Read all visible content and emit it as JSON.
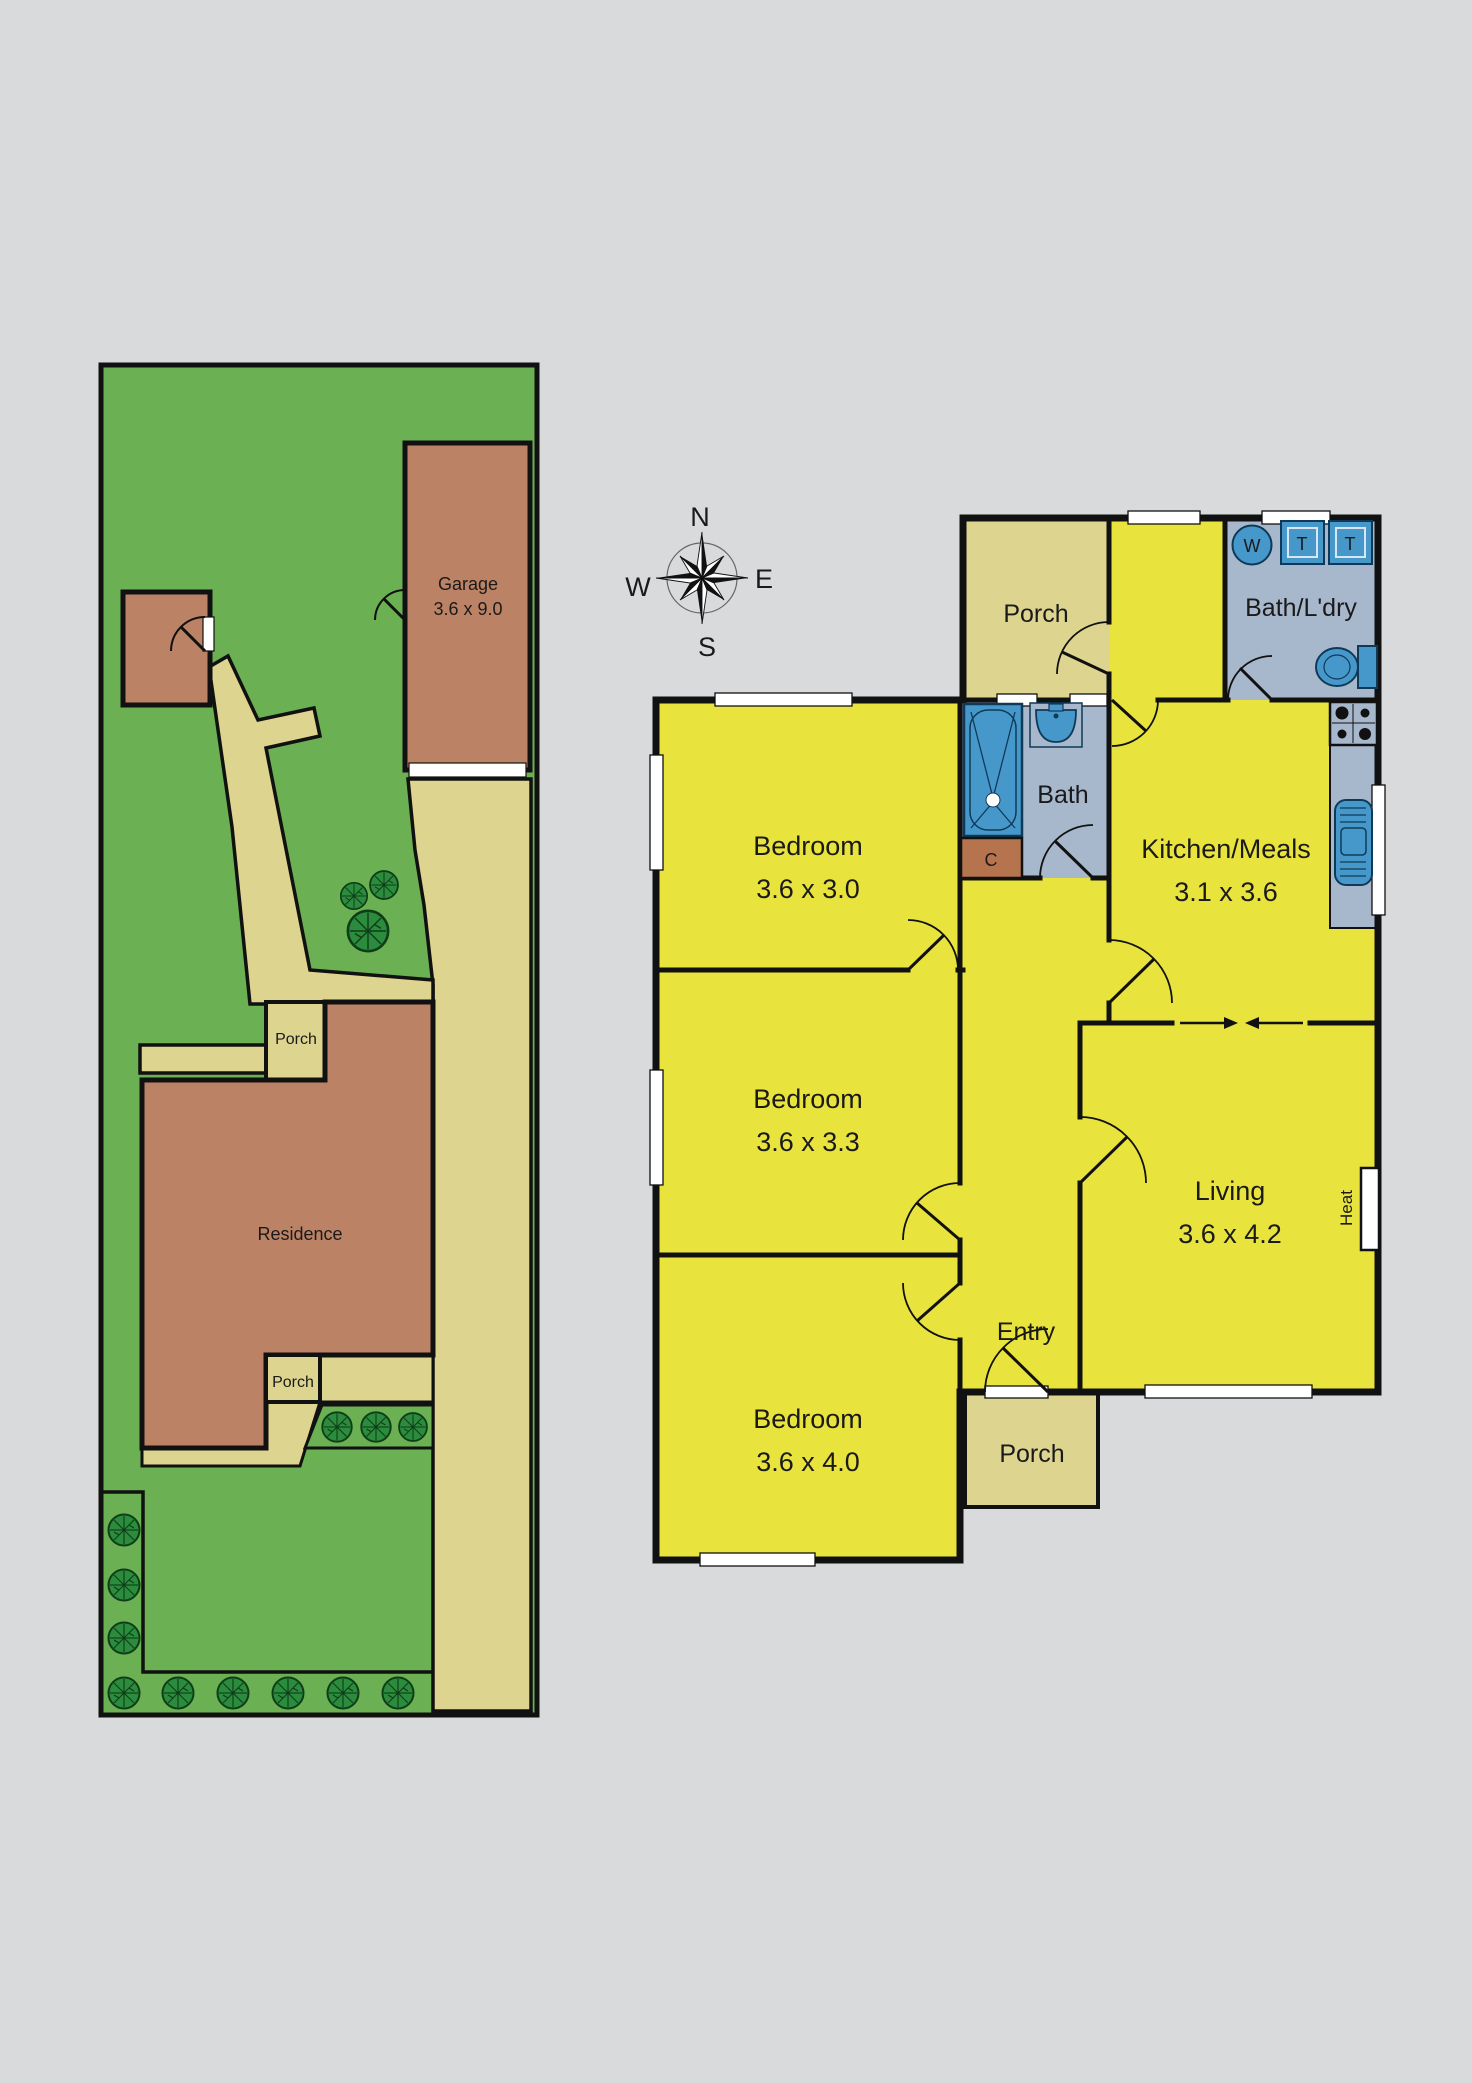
{
  "compass": {
    "north": "N",
    "east": "E",
    "south": "S",
    "west": "W"
  },
  "site_plan": {
    "garage_label": "Garage",
    "garage_dims": "3.6 x 9.0",
    "residence_label": "Residence",
    "porch_upper_label": "Porch",
    "porch_lower_label": "Porch"
  },
  "floor_plan": {
    "bedroom1_label": "Bedroom",
    "bedroom1_dims": "3.6 x 3.0",
    "bedroom2_label": "Bedroom",
    "bedroom2_dims": "3.6 x 3.3",
    "bedroom3_label": "Bedroom",
    "bedroom3_dims": "3.6 x 4.0",
    "kitchen_label": "Kitchen/Meals",
    "kitchen_dims": "3.1 x 3.6",
    "living_label": "Living",
    "living_dims": "3.6 x 4.2",
    "bath_label": "Bath",
    "bath_laundry_label": "Bath/L'dry",
    "porch_top_label": "Porch",
    "porch_bottom_label": "Porch",
    "entry_label": "Entry",
    "heater_label": "Heat",
    "cupboard_label": "C",
    "washer_label": "W",
    "trough1_label": "T",
    "trough2_label": "T"
  },
  "colors": {
    "background": "#d9dadb",
    "grass_green": "#6bb052",
    "tree_green": "#2a8c3c",
    "building_brown": "#bc8265",
    "cupboard_brown": "#b5744d",
    "path_tan": "#ddd48f",
    "room_yellow": "#e9e33e",
    "wet_area_blue_gray": "#a7b7cc",
    "fixture_blue": "#4698cb",
    "wall_black": "#111111"
  }
}
